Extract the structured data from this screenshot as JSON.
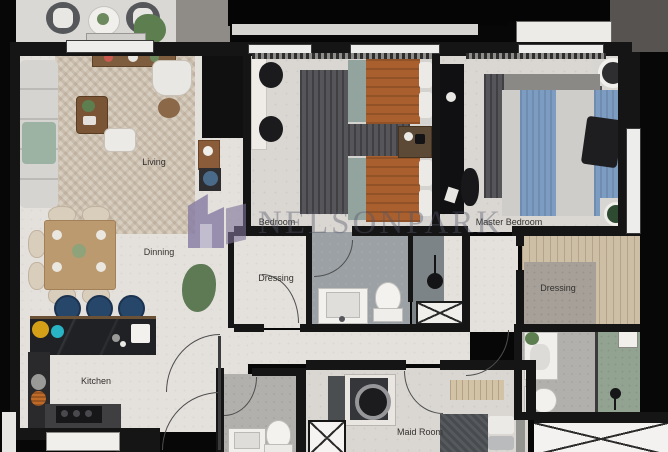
{
  "plan": {
    "watermark": {
      "text": "NELSONPARK",
      "logo_color": "#9186ad"
    },
    "rooms": {
      "living": "Living",
      "dinning": "Dinning",
      "kitchen": "Kitchen",
      "bedroom": "Bedroom",
      "master_bedroom": "Master Bedroom",
      "dressing_1": "Dressing",
      "dressing_2": "Dressing",
      "maid_room": "Maid Room"
    },
    "colors": {
      "wall": "#151515",
      "floor_light": "#e4e1dd",
      "rug_beige": "#d8cec0",
      "rug_dark": "#56565a",
      "bed_rust": "#a9602e",
      "bed_blue": "#7d9cc2",
      "stool_navy": "#27476a",
      "counter_dark": "#202124",
      "shower_green": "#93a392",
      "bath_gray": "#9ba1a5"
    }
  }
}
